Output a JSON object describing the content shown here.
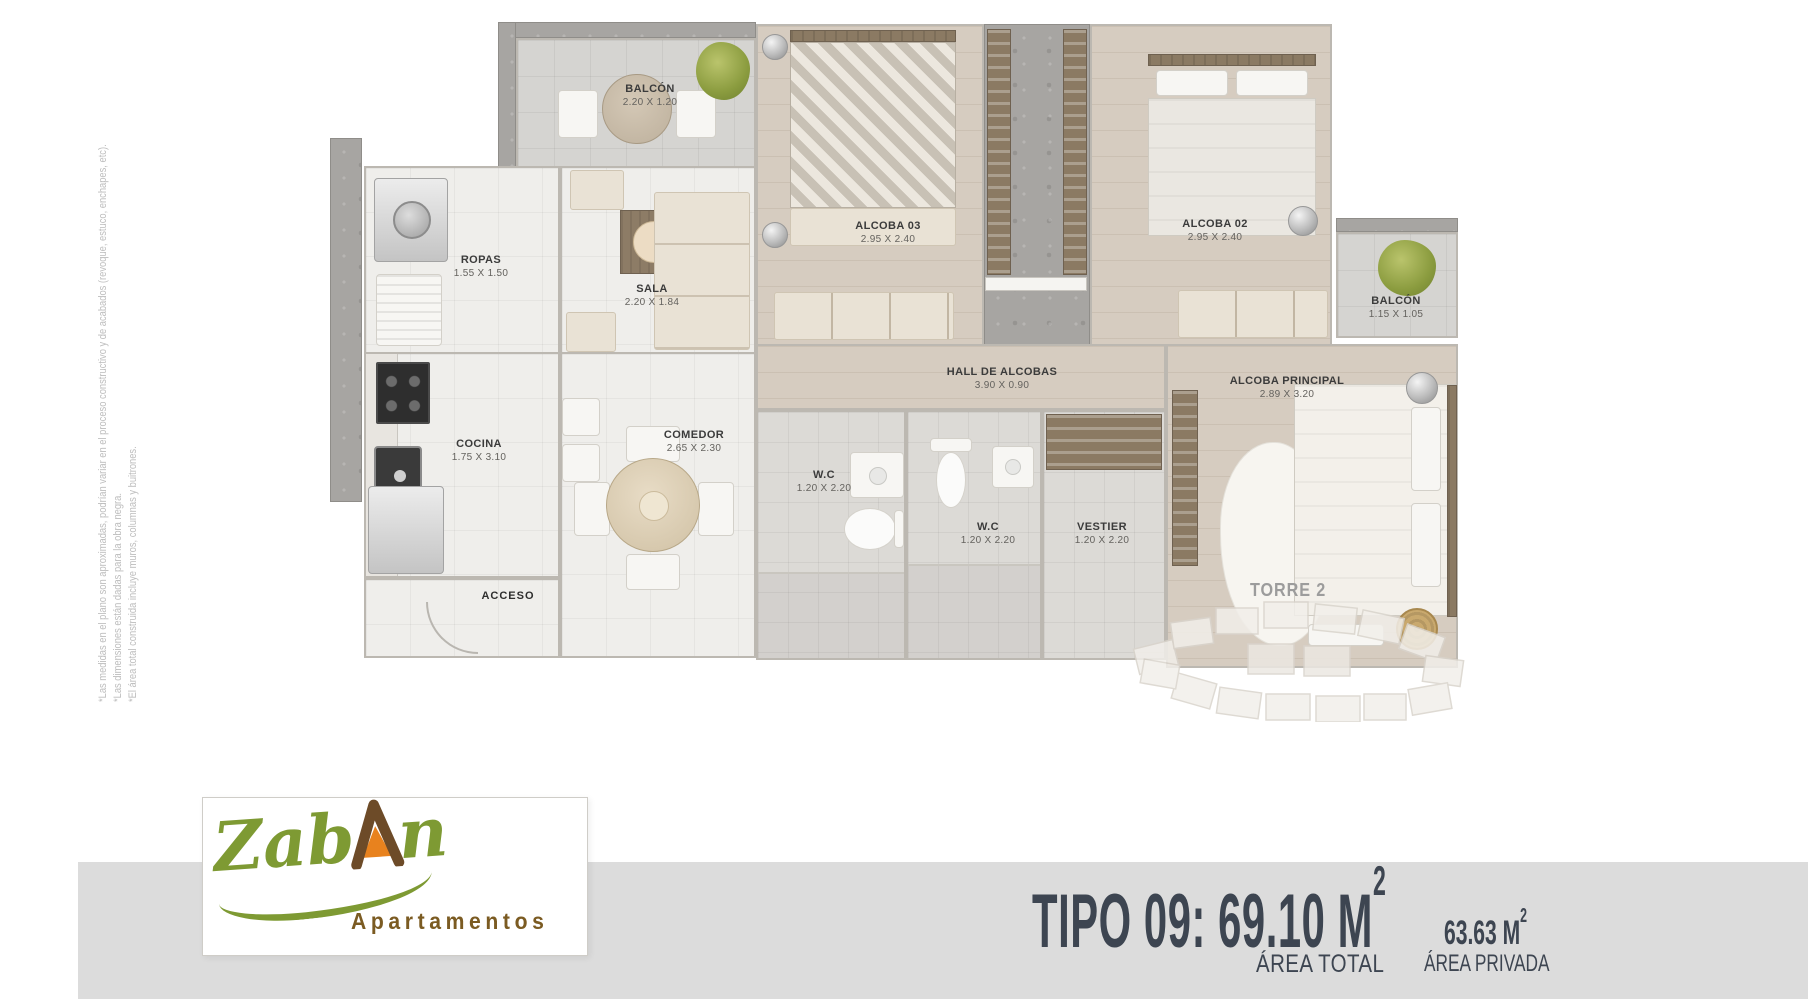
{
  "disclaimer": {
    "line1": "*Las medidas en el plano son aproximadas, podrían variar en el proceso constructivo y de acabados (revoque, estuco, enchapes, etc).",
    "line2": "*Las dimensiones están dadas para la obra negra.",
    "line3": "*El área total construida incluye muros, columnas y buitrones."
  },
  "plan": {
    "rooms": {
      "balcon_top": {
        "name": "BALCÓN",
        "dims": "2.20 X 1.20"
      },
      "ropas": {
        "name": "ROPAS",
        "dims": "1.55 X 1.50"
      },
      "sala": {
        "name": "SALA",
        "dims": "2.20 X 1.84"
      },
      "alcoba03": {
        "name": "ALCOBA 03",
        "dims": "2.95 X 2.40"
      },
      "alcoba02": {
        "name": "ALCOBA 02",
        "dims": "2.95 X 2.40"
      },
      "balcon_right": {
        "name": "BALCÓN",
        "dims": "1.15 X 1.05"
      },
      "cocina": {
        "name": "COCINA",
        "dims": "1.75 X 3.10"
      },
      "comedor": {
        "name": "COMEDOR",
        "dims": "2.65 X 2.30"
      },
      "hall": {
        "name": "HALL DE ALCOBAS",
        "dims": "3.90 X 0.90"
      },
      "wc1": {
        "name": "W.C",
        "dims": "1.20 X 2.20"
      },
      "wc2": {
        "name": "W.C",
        "dims": "1.20 X 2.20"
      },
      "vestier": {
        "name": "VESTIER",
        "dims": "1.20 X 2.20"
      },
      "alcoba_principal": {
        "name": "ALCOBA PRINCIPAL",
        "dims": "2.89 X 3.20"
      },
      "acceso": {
        "label": "ACCESO"
      }
    }
  },
  "torre": {
    "label": "TORRE 2"
  },
  "logo": {
    "part1": "Zab",
    "part2": "A",
    "part3": "n",
    "subtitle": "Apartamentos"
  },
  "summary": {
    "tipo_value": "TIPO 09: 69.10 M",
    "tipo_sup": "2",
    "area_total_label": "ÁREA TOTAL",
    "privada_value": "63.63 M",
    "privada_sup": "2",
    "privada_label": "ÁREA PRIVADA"
  },
  "colors": {
    "brand_green": "#7e9a33",
    "brand_brown": "#6d4b28",
    "brand_orange": "#e8821e",
    "band_gray": "#dcdcdc",
    "title_slate": "#3d4551",
    "label_dark": "#3b3b3b",
    "disclaimer_gray": "#bdbdbd"
  }
}
